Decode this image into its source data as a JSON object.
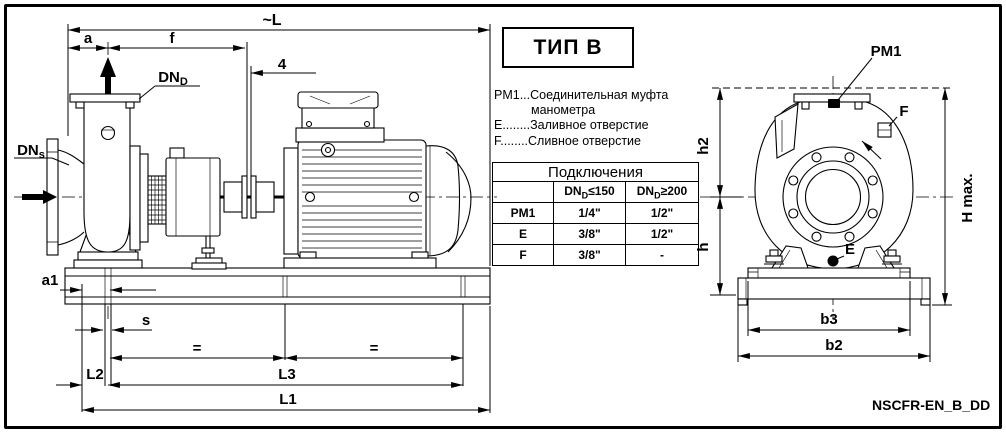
{
  "title_box": {
    "label": "ТИП B"
  },
  "legend": {
    "line1": "PM1...Соединительная муфта",
    "line2": "манометра",
    "line3": "E........Заливное отверстие",
    "line4": "F........Сливное отверстие"
  },
  "table": {
    "title": "Подключения",
    "columns": [
      {
        "prefix": "DN",
        "sub": "D",
        "cond": "≤150"
      },
      {
        "prefix": "DN",
        "sub": "D",
        "cond": "≥200"
      }
    ],
    "rows": [
      {
        "name": "PM1",
        "small": "1/4\"",
        "large": "1/2\""
      },
      {
        "name": "E",
        "small": "3/8\"",
        "large": "1/2\""
      },
      {
        "name": "F",
        "small": "3/8\"",
        "large": "-"
      }
    ]
  },
  "side_view": {
    "labels": {
      "overall_length": "~L",
      "a": "a",
      "f": "f",
      "gap": "4",
      "dn_d": {
        "prefix": "DN",
        "sub": "D"
      },
      "dn_s": {
        "prefix": "DN",
        "sub": "s"
      },
      "a1": "a1",
      "s": "s",
      "eq_left": "=",
      "eq_right": "=",
      "L2": "L2",
      "L3": "L3",
      "L1": "L1"
    }
  },
  "front_view": {
    "labels": {
      "pm1": "PM1",
      "drain": "F",
      "fill": "E",
      "h2": "h2",
      "h": "h",
      "h_max": "H max.",
      "b3": "b3",
      "b2": "b2"
    }
  },
  "footer": {
    "doc_code": "NSCFR-EN_B_DD"
  }
}
